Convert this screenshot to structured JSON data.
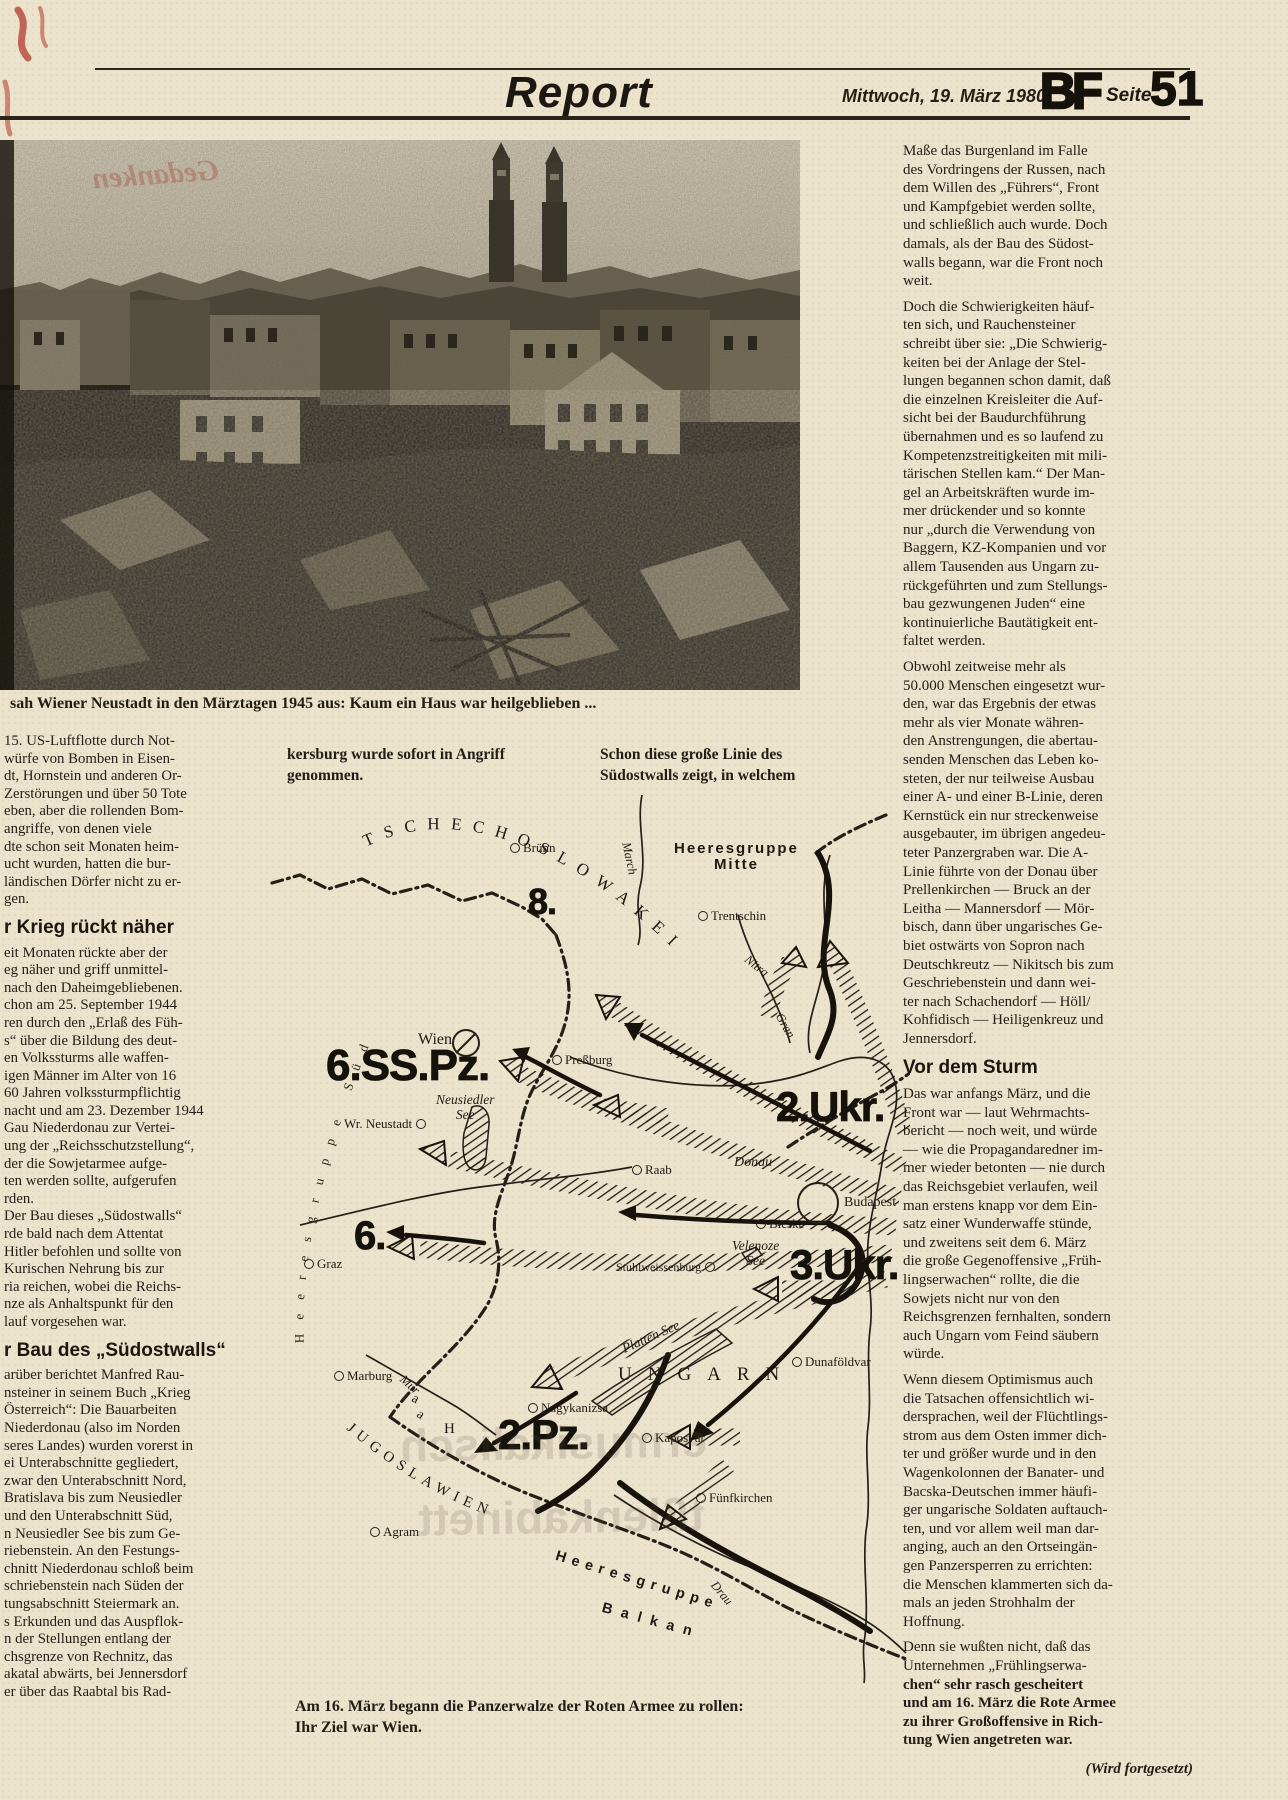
{
  "palette": {
    "paper": "#ece3cd",
    "ink": "#221d15",
    "red_mark": "#b23b2e"
  },
  "header": {
    "section_title": "Report",
    "date": "Mittwoch, 19. März 1980",
    "logo": "BF",
    "seite_label": "Seite",
    "page_number": "51"
  },
  "photo": {
    "caption": "sah Wiener Neustadt in den Märztagen 1945 aus: Kaum ein Haus war heilgeblieben ..."
  },
  "left_column": {
    "para1_lines": [
      "15. US-Luftflotte durch Not-",
      "würfe von Bomben in Eisen-",
      "dt, Hornstein und anderen Or-",
      "Zerstörungen und über 50 Tote",
      "eben, aber die rollenden Bom-",
      "angriffe, von denen viele",
      "dte schon seit Monaten heim-",
      "ucht wurden, hatten die bur-",
      "ländischen Dörfer nicht zu er-",
      "gen."
    ],
    "heading1": "r Krieg rückt näher",
    "para2_lines": [
      "eit Monaten rückte aber der",
      "eg näher und griff unmittel-",
      "nach den Daheimgebliebenen.",
      "chon am 25. September 1944",
      "ren durch den „Erlaß des Füh-",
      "s“ über die Bildung des deut-",
      "en Volkssturms alle waffen-",
      "igen Männer im Alter von 16",
      "60 Jahren volkssturmpflichtig",
      "nacht und am 23. Dezember 1944",
      "Gau Niederdonau zur Vertei-",
      "ung der „Reichsschutzstellung“,",
      "der die Sowjetarmee aufge-",
      "ten werden sollte, aufgerufen",
      "rden.",
      "Der Bau dieses „Südostwalls“",
      "rde bald nach dem Attentat",
      "Hitler befohlen und sollte von",
      "Kurischen Nehrung bis zur",
      "ria reichen, wobei die Reichs-",
      "nze als Anhaltspunkt für den",
      "lauf vorgesehen war."
    ],
    "heading2": "r Bau des „Südostwalls“",
    "para3_lines": [
      "arüber berichtet Manfred Rau-",
      "nsteiner in seinem Buch „Krieg",
      "Österreich“: Die Bauarbeiten",
      "Niederdonau (also im Norden",
      "seres Landes) wurden vorerst in",
      "ei Unterabschnitte gegliedert,",
      "zwar den Unterabschnitt Nord,",
      "Bratislava bis zum Neusiedler",
      "und den Unterabschnitt Süd,",
      "n Neusiedler See bis zum Ge-",
      "riebenstein. An den Festungs-",
      "chnitt Niederdonau schloß beim",
      "schriebenstein nach Süden der",
      "tungsabschnitt Steiermark an.",
      "s Erkunden und das Auspflok-",
      "n der Stellungen entlang der",
      "chsgrenze von Rechnitz, das",
      "akatal abwärts, bei Jennersdorf",
      "er über das Raabtal bis Rad-"
    ]
  },
  "middle": {
    "intro_left_lines": [
      "kersburg wurde sofort in Angriff",
      "genommen."
    ],
    "intro_right_lines": [
      "Schon diese große Linie des",
      "Südostwalls zeigt, in welchem"
    ],
    "map_caption_lines": [
      "Am 16. März begann die Panzerwalze der Roten Armee zu rollen:",
      "Ihr Ziel war Wien."
    ]
  },
  "right_column": {
    "para1_lines": [
      "Maße das Burgenland im Falle",
      "des Vordringens der Russen, nach",
      "dem Willen des „Führers“, Front",
      "und Kampfgebiet werden sollte,",
      "und schließlich auch wurde. Doch",
      "damals, als der Bau des Südost-",
      "walls begann, war die Front noch",
      "weit."
    ],
    "para2_lines": [
      "Doch die Schwierigkeiten häuf-",
      "ten sich, und Rauchensteiner",
      "schreibt über sie: „Die Schwierig-",
      "keiten bei der Anlage der Stel-",
      "lungen begannen schon damit, daß",
      "die einzelnen Kreisleiter die Auf-",
      "sicht bei der Baudurchführung",
      "übernahmen und es so laufend zu",
      "Kompetenzstreitigkeiten mit mili-",
      "tärischen Stellen kam.“ Der Man-",
      "gel an Arbeitskräften wurde im-",
      "mer drückender und so konnte",
      "nur „durch die Verwendung von",
      "Baggern, KZ-Kompanien und vor",
      "allem Tausenden aus Ungarn zu-",
      "rückgeführten und zum Stellungs-",
      "bau gezwungenen Juden“ eine",
      "kontinuierliche Bautätigkeit ent-",
      "faltet werden."
    ],
    "para3_lines": [
      "Obwohl zeitweise mehr als",
      "50.000 Menschen eingesetzt wur-",
      "den, war das Ergebnis der etwas",
      "mehr als vier Monate währen-",
      "den Anstrengungen, die abertau-",
      "senden Menschen das Leben ko-",
      "steten, der nur teilweise Ausbau",
      "einer A- und einer B-Linie, deren",
      "Kernstück ein nur streckenweise",
      "ausgebauter, im übrigen angedeu-",
      "teter Panzergraben war. Die A-",
      "Linie führte von der Donau über",
      "Prellenkirchen — Bruck an der",
      "Leitha — Mannersdorf — Mör-",
      "bisch, dann über ungarisches Ge-",
      "biet ostwärts von Sopron nach",
      "Deutschkreutz — Nikitsch bis zum",
      "Geschriebenstein und dann wei-",
      "ter nach Schachendorf — Höll/",
      "Kohfidisch — Heiligenkreuz und",
      "Jennersdorf."
    ],
    "heading": "Vor dem Sturm",
    "para4_lines": [
      "Das war anfangs März, und die",
      "Front war — laut Wehrmachts-",
      "bericht — noch weit, und würde",
      "— wie die Propagandaredner im-",
      "mer wieder betonten — nie durch",
      "das Reichsgebiet verlaufen, weil",
      "man erstens knapp vor dem Ein-",
      "satz einer Wunderwaffe stünde,",
      "und zweitens seit dem 6. März",
      "die große Gegenoffensive „Früh-",
      "lingserwachen“ rollte, die die",
      "Sowjets nicht nur von den",
      "Reichsgrenzen fernhalten, sondern",
      "auch Ungarn vom Feind säubern",
      "würde."
    ],
    "para5_lines": [
      "Wenn diesem Optimismus auch",
      "die Tatsachen offensichtlich wi-",
      "dersprachen, weil der Flüchtlings-",
      "strom aus dem Osten immer dich-",
      "ter und größer wurde und in den",
      "Wagenkolonnen der Banater- und",
      "Bacska-Deutschen immer häufi-",
      "ger ungarische Soldaten auftauch-",
      "ten, und vor allem weil man dar-",
      "anging, auch an den Ortseingän-",
      "gen Panzersperren zu errichten:",
      "die Menschen klammerten sich da-",
      "mals an jeden Strohhalm der",
      "Hoffnung."
    ],
    "para6_lines": [
      "Denn sie wußten nicht, daß das",
      "Unternehmen „Frühlingserwa-"
    ],
    "para6b_lines": [
      "chen“ sehr rasch gescheitert",
      "und am 16. März die Rote Armee",
      "zu ihrer Großoffensive in Rich-",
      "tung Wien angetreten war."
    ],
    "signoff": "(Wird fortgesetzt)"
  },
  "ghost": {
    "line1": "ermusikalisch",
    "line2": "tßlenkabinett",
    "red_note": "Gedanken"
  },
  "map": {
    "textpaths": [
      {
        "name": "country-czechoslovakia-label",
        "path": "tp-cz",
        "text": "TSCHECHOSLOWAKEI",
        "cls": "tp-country"
      },
      {
        "name": "country-jugoslawien-label",
        "path": "tp-yu",
        "text": "JUGOSLAWIEN",
        "cls": "tp-yu"
      },
      {
        "name": "heeresgruppe-sued-label",
        "path": "tp-sued",
        "text": "Heeresgruppe Süd",
        "cls": "tp-sued"
      }
    ],
    "labels": [
      {
        "name": "city-bruenn",
        "text": "Brünn",
        "x": 240,
        "y": 46,
        "cls": "m-city",
        "circle": "left"
      },
      {
        "name": "hq-mitte-label",
        "text": "Heeresgruppe\nMitte",
        "x": 404,
        "y": 46,
        "cls": "m-hq"
      },
      {
        "name": "river-march-label",
        "text": "March",
        "x": 362,
        "y": 46,
        "cls": "m-river",
        "rot": 78
      },
      {
        "name": "city-trentschin",
        "text": "Trentschin",
        "x": 428,
        "y": 114,
        "cls": "m-city",
        "circle": "left"
      },
      {
        "name": "army-8-label",
        "text": "8.",
        "x": 258,
        "y": 90,
        "cls": "m-army",
        "size": 36
      },
      {
        "name": "river-nitra-label",
        "text": "Nitra",
        "x": 480,
        "y": 158,
        "cls": "m-river",
        "rot": 38
      },
      {
        "name": "river-gran-label",
        "text": "Gran",
        "x": 514,
        "y": 216,
        "cls": "m-river",
        "rot": 60
      },
      {
        "name": "city-wien",
        "text": "Wien",
        "x": 148,
        "y": 236,
        "cls": "m-city",
        "size": 16
      },
      {
        "name": "city-pressburg",
        "text": "Preßburg",
        "x": 282,
        "y": 258,
        "cls": "m-city",
        "circle": "left"
      },
      {
        "name": "army-6sspz-label",
        "text": "6.SS.Pz.",
        "x": 56,
        "y": 250,
        "cls": "m-army",
        "size": 44
      },
      {
        "name": "lake-neusiedler-label",
        "text": "Neusiedler\nSee",
        "x": 166,
        "y": 298,
        "cls": "m-lake"
      },
      {
        "name": "city-wr-neustadt",
        "text": "Wr. Neustadt",
        "x": 74,
        "y": 322,
        "cls": "m-city",
        "circle": "right"
      },
      {
        "name": "army-2ukr-label",
        "text": "2.Ukr.",
        "x": 506,
        "y": 292,
        "cls": "m-army",
        "size": 42
      },
      {
        "name": "city-raab",
        "text": "Raab",
        "x": 362,
        "y": 368,
        "cls": "m-city",
        "circle": "left"
      },
      {
        "name": "river-donau-label",
        "text": "Donau",
        "x": 464,
        "y": 360,
        "cls": "m-river",
        "size": 14
      },
      {
        "name": "city-budapest",
        "text": "Budapest",
        "x": 574,
        "y": 400,
        "cls": "m-city",
        "size": 14
      },
      {
        "name": "city-bicske",
        "text": "Bicske",
        "x": 486,
        "y": 422,
        "cls": "m-city",
        "circle": "left"
      },
      {
        "name": "city-stuhlweissenburg",
        "text": "Stuhlweissenburg",
        "x": 346,
        "y": 466,
        "cls": "m-city",
        "size": 12,
        "circle": "right"
      },
      {
        "name": "lake-velenoze-label",
        "text": "Velenoze\nSee",
        "x": 462,
        "y": 444,
        "cls": "m-lake"
      },
      {
        "name": "army-3ukr-label",
        "text": "3.Ukr.",
        "x": 520,
        "y": 450,
        "cls": "m-army",
        "size": 42
      },
      {
        "name": "army-6-label",
        "text": "6.",
        "x": 84,
        "y": 422,
        "cls": "m-army",
        "size": 40
      },
      {
        "name": "city-graz",
        "text": "Graz",
        "x": 34,
        "y": 462,
        "cls": "m-city",
        "circle": "left"
      },
      {
        "name": "lake-platten-label",
        "text": "Platten See",
        "x": 350,
        "y": 548,
        "cls": "m-lake",
        "rot": -24
      },
      {
        "name": "city-dunafoeldvar",
        "text": "Dunaföldvar",
        "x": 522,
        "y": 560,
        "cls": "m-city",
        "circle": "left"
      },
      {
        "name": "country-ungarn-label",
        "text": "UNGARN",
        "x": 348,
        "y": 570,
        "cls": "m-country"
      },
      {
        "name": "city-marburg",
        "text": "Marburg",
        "x": 64,
        "y": 574,
        "cls": "m-city",
        "circle": "left"
      },
      {
        "name": "river-mur-label",
        "text": "Mur",
        "x": 136,
        "y": 578,
        "cls": "m-river",
        "rot": 42
      },
      {
        "name": "river-letter-a1",
        "text": "a",
        "x": 146,
        "y": 596,
        "cls": "m-letter",
        "rot": 28
      },
      {
        "name": "river-letter-a2",
        "text": "a",
        "x": 152,
        "y": 612,
        "cls": "m-letter",
        "rot": 34
      },
      {
        "name": "river-letter-h",
        "text": "H",
        "x": 174,
        "y": 626,
        "cls": "m-letter",
        "size": 15
      },
      {
        "name": "city-nagykanizsa",
        "text": "Nagykanizsa",
        "x": 258,
        "y": 606,
        "cls": "m-city",
        "circle": "left"
      },
      {
        "name": "army-2pz-label",
        "text": "2.Pz.",
        "x": 228,
        "y": 620,
        "cls": "m-army",
        "size": 42
      },
      {
        "name": "city-kaposvar",
        "text": "Kaposvar",
        "x": 372,
        "y": 636,
        "cls": "m-city",
        "circle": "left"
      },
      {
        "name": "city-fuenfkirchen",
        "text": "Fünfkirchen",
        "x": 426,
        "y": 696,
        "cls": "m-city",
        "circle": "left"
      },
      {
        "name": "city-agram",
        "text": "Agram",
        "x": 100,
        "y": 730,
        "cls": "m-city",
        "circle": "left"
      },
      {
        "name": "hq-balkan-label-1",
        "text": "Heeresgruppe",
        "x": 288,
        "y": 754,
        "cls": "m-balkan",
        "rot": 17,
        "ls": 6
      },
      {
        "name": "hq-balkan-label-2",
        "text": "Balkan",
        "x": 334,
        "y": 806,
        "cls": "m-balkan",
        "rot": 15,
        "ls": 9
      },
      {
        "name": "river-drau-label",
        "text": "Drau",
        "x": 448,
        "y": 784,
        "cls": "m-river",
        "rot": 50
      }
    ]
  }
}
